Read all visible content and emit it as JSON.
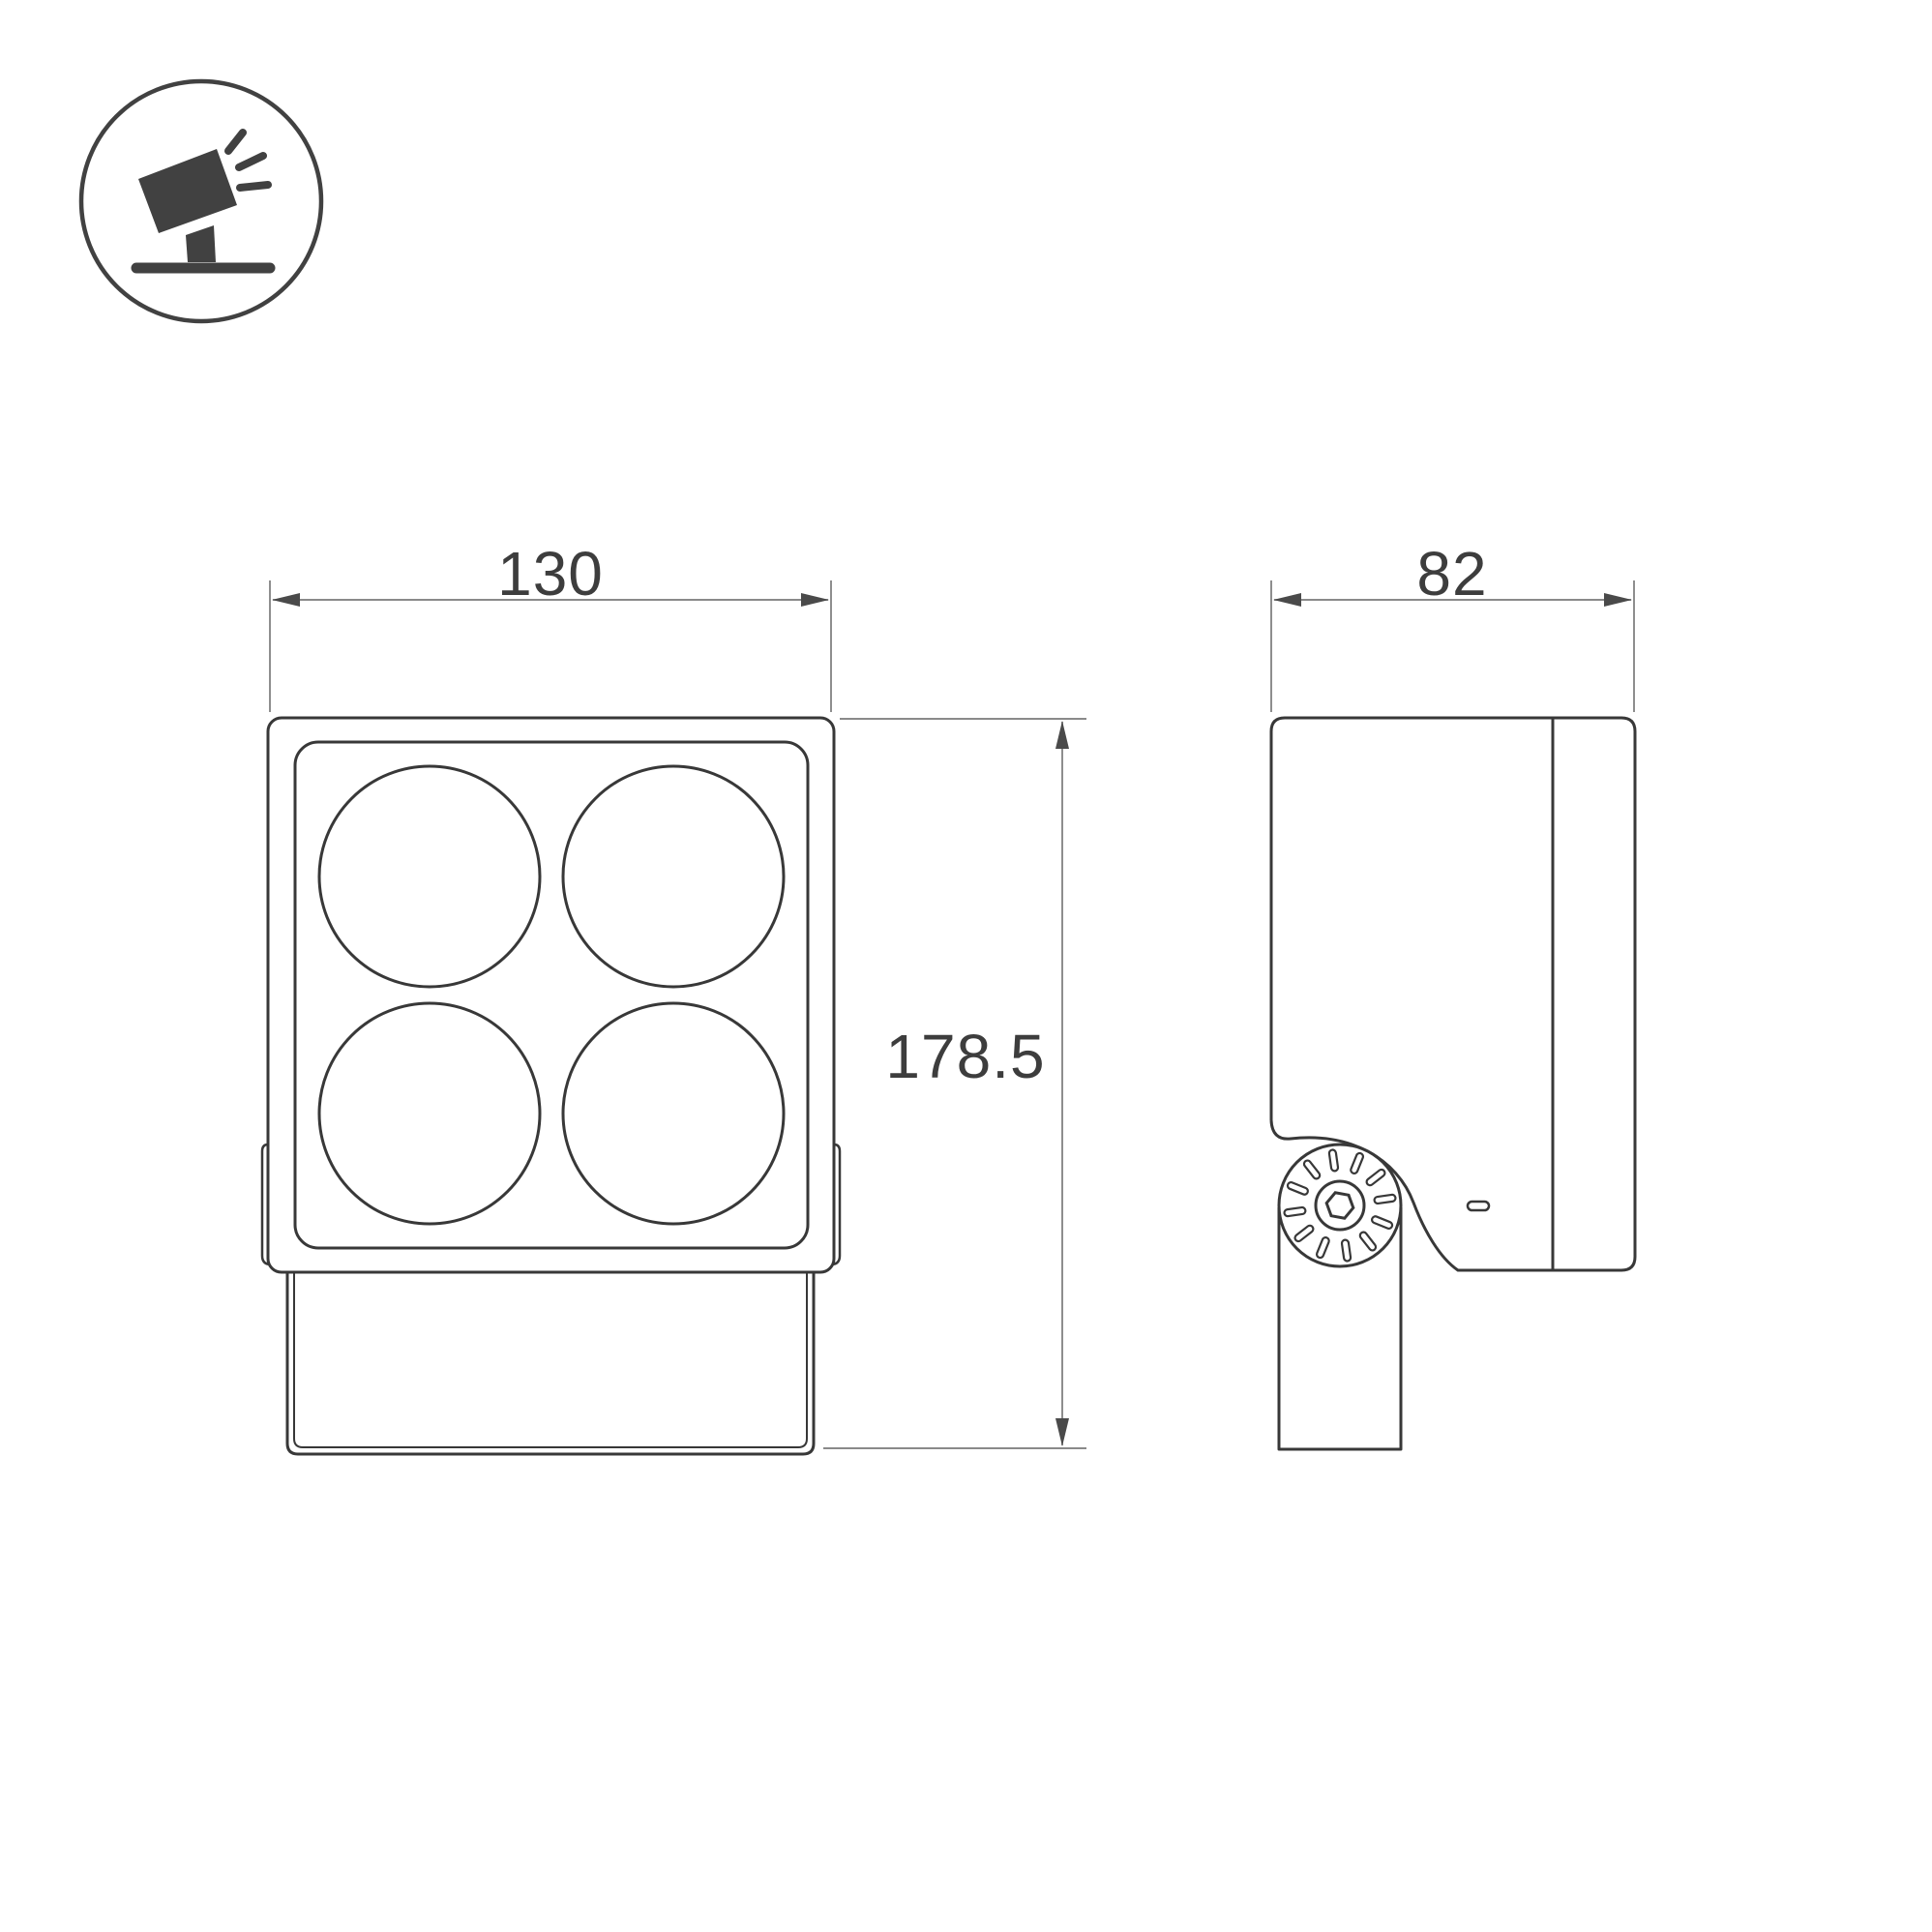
{
  "page": {
    "background": "#ffffff"
  },
  "icon": {
    "name": "tilted-floodlight-on-stand",
    "color": "#414141"
  },
  "drawing": {
    "type": "technical-dimension-drawing",
    "line_color": "#383838",
    "dimension_line_color": "#7a7a7a",
    "arrow_color": "#4a4a4a",
    "text_color": "#3d3d3d",
    "front_view": {
      "lens_count": 4,
      "lens_layout": "2x2"
    },
    "side_view": {
      "features": [
        "mounting-bracket-arm",
        "adjustment-knob",
        "hex-socket-screw"
      ]
    },
    "dimensions": {
      "front_width": "130",
      "side_depth": "82",
      "overall_height": "178.5"
    }
  }
}
